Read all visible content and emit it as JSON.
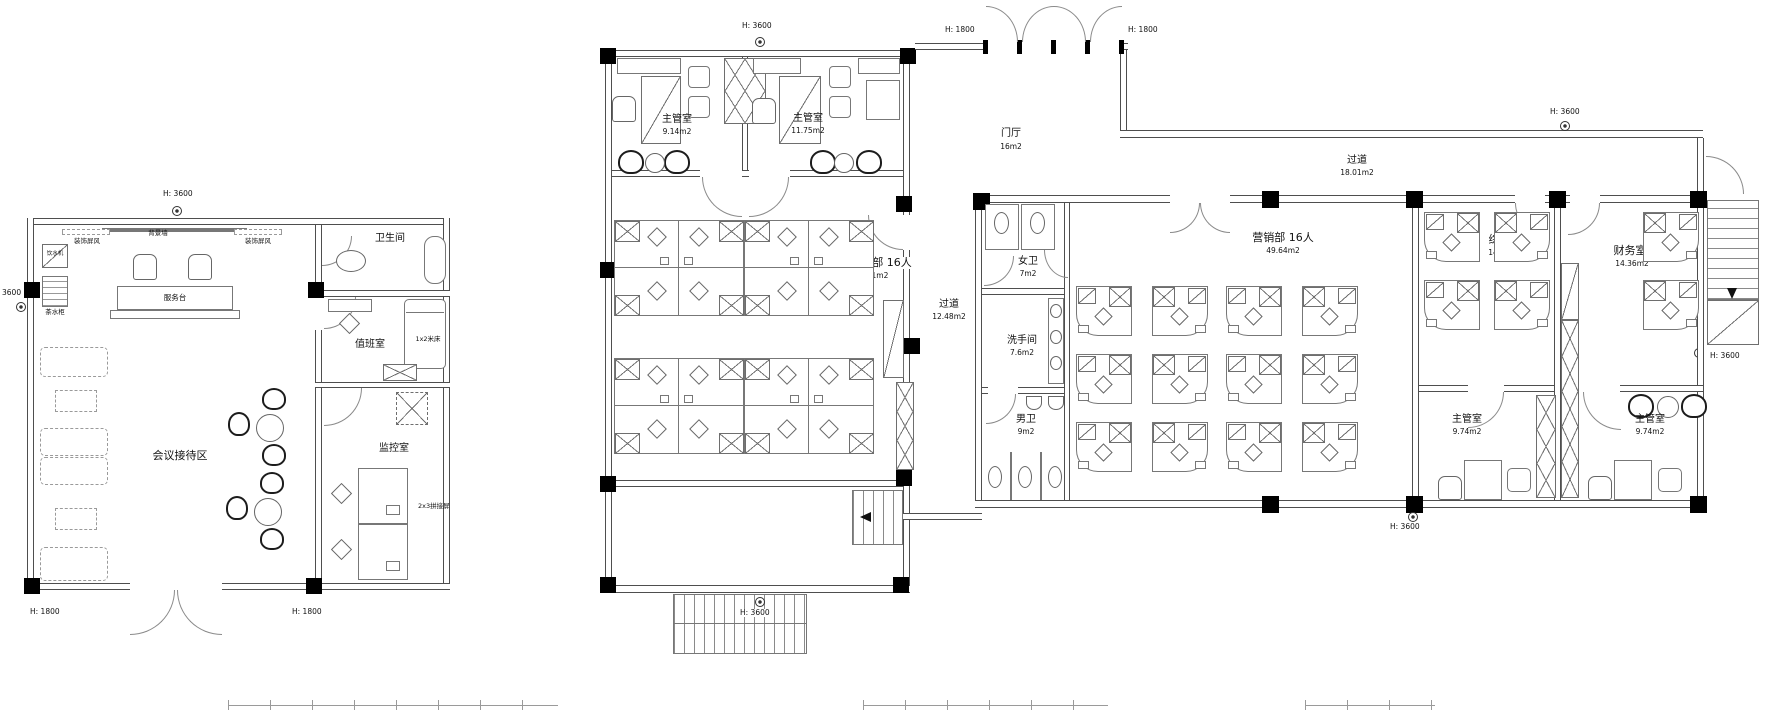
{
  "left_building": {
    "reception": "会议接待区",
    "toilet": "卫生间",
    "duty_room": "值班室",
    "monitor_room": "监控室",
    "service_desk": "服务台",
    "bg_wall": "背景墙",
    "deco_screen": "装饰屏风",
    "water_dispenser": "饮水机",
    "tea_cabinet": "茶水柜",
    "bed": "1x2米床",
    "splice_screen": "2x3拼接屏"
  },
  "middle_building": {
    "super1_name": "主管室",
    "super1_area": "9.14m2",
    "super2_name": "主管室",
    "super2_area": "11.75m2",
    "office_name": "招商部 16人",
    "office_area": "54.1m2"
  },
  "foyer": {
    "name": "门厅",
    "area": "16m2"
  },
  "corridor_v": {
    "name": "过道",
    "area": "12.48m2"
  },
  "corridor_top": {
    "name": "过道",
    "area": "18.01m2"
  },
  "right_building": {
    "wc_women_name": "女卫",
    "wc_women_area": "7m2",
    "washroom_name": "洗手间",
    "washroom_area": "7.6m2",
    "wc_men_name": "男卫",
    "wc_men_area": "9m2",
    "marketing_name": "营销部 16人",
    "marketing_area": "49.64m2",
    "general_name": "综合部",
    "general_area": "14.36m2",
    "finance_name": "财务室",
    "finance_area": "14.36m2",
    "super3_name": "主管室",
    "super3_area": "9.74m2",
    "super4_name": "主管室",
    "super4_area": "9.74m2"
  },
  "dims": {
    "h3600": "H: 3600",
    "h1800": "H: 1800",
    "v3600": "3600"
  }
}
